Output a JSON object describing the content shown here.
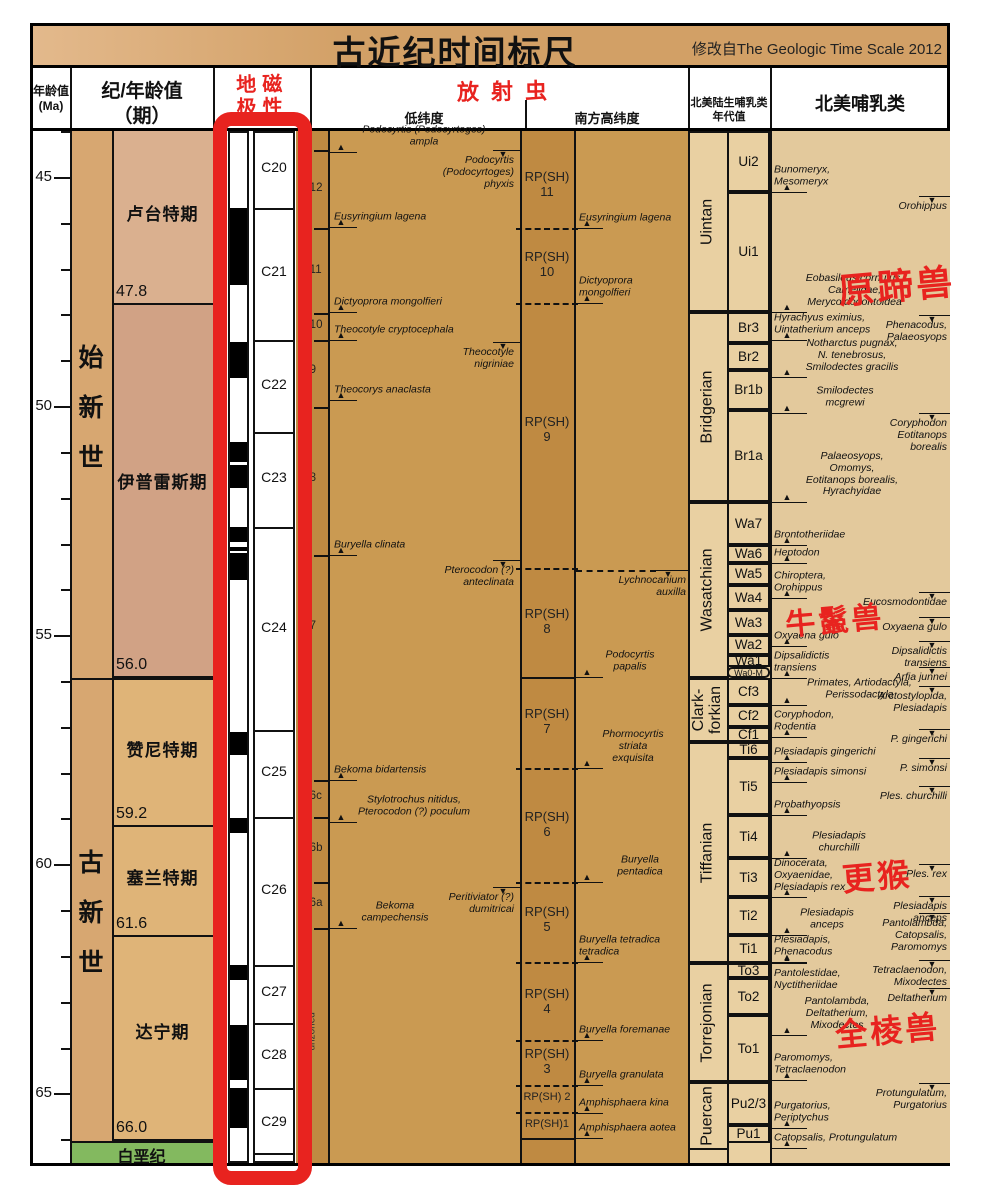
{
  "title": "古近纪时间标尺",
  "source_note": "修改自The Geologic Time Scale 2012",
  "headers": {
    "age": "年龄值\n(Ma)",
    "period": "纪/年龄值\n（期）",
    "magnetic": "地磁\n极性",
    "radiolarian": "放射虫",
    "low_lat": "低纬度",
    "south_high_lat": "南方高纬度",
    "nalma": "北美陆生哺乳类\n年代值",
    "mammal": "北美哺乳类"
  },
  "chart_data": {
    "type": "stratigraphic_time_scale",
    "title": "古近纪时间标尺",
    "source_note": "修改自The Geologic Time Scale 2012",
    "age_axis": {
      "unit": "Ma",
      "major_ticks": [
        45,
        50,
        55,
        60,
        65
      ],
      "minor_ticks": [
        44,
        46,
        47,
        48,
        49,
        51,
        52,
        53,
        54,
        56,
        57,
        58,
        59,
        61,
        62,
        63,
        64,
        66
      ],
      "y_at_45": 177,
      "px_per_ma": 45.82
    },
    "epochs": [
      {
        "name": "始新世",
        "y1": 131,
        "y2": 678
      },
      {
        "name": "古新世",
        "y1": 678,
        "y2": 1141
      }
    ],
    "stages": [
      {
        "name": "卢台特期",
        "y1": 131,
        "y2": 305,
        "color": "#dab08f",
        "label_y": 212
      },
      {
        "name": "伊普雷斯期",
        "y1": 305,
        "y2": 678,
        "color": "#d1a285",
        "label_y": 480
      },
      {
        "name": "赞尼特期",
        "y1": 678,
        "y2": 827,
        "color": "#dfb478",
        "label_y": 748
      },
      {
        "name": "塞兰特期",
        "y1": 827,
        "y2": 937,
        "color": "#dfb478",
        "label_y": 876
      },
      {
        "name": "达宁期",
        "y1": 937,
        "y2": 1141,
        "color": "#dfb478",
        "label_y": 1030
      }
    ],
    "boundary_ages": [
      {
        "v": "47.8",
        "y": 305
      },
      {
        "v": "56.0",
        "y": 678
      },
      {
        "v": "59.2",
        "y": 827
      },
      {
        "v": "61.6",
        "y": 937
      },
      {
        "v": "66.0",
        "y": 1141
      }
    ],
    "cretaceous": {
      "label": "白垩纪",
      "y1": 1141,
      "y2": 1163,
      "color": "#83b95f"
    },
    "polarity": {
      "black_segments": [
        [
          208,
          285
        ],
        [
          342,
          378
        ],
        [
          442,
          462
        ],
        [
          465,
          488
        ],
        [
          527,
          542
        ],
        [
          547,
          551
        ],
        [
          553,
          580
        ],
        [
          732,
          755
        ],
        [
          818,
          833
        ],
        [
          965,
          980
        ],
        [
          1025,
          1080
        ],
        [
          1088,
          1128
        ]
      ],
      "chron_dividers": [
        208,
        340,
        432,
        527,
        730,
        817,
        965,
        1023,
        1088,
        1153
      ],
      "chrons": [
        {
          "label": "C20",
          "y": 168
        },
        {
          "label": "C21",
          "y": 272
        },
        {
          "label": "C22",
          "y": 385
        },
        {
          "label": "C23",
          "y": 478
        },
        {
          "label": "C24",
          "y": 628
        },
        {
          "label": "C25",
          "y": 772
        },
        {
          "label": "C26",
          "y": 890
        },
        {
          "label": "C27",
          "y": 992
        },
        {
          "label": "C28",
          "y": 1055
        },
        {
          "label": "C29",
          "y": 1122
        }
      ]
    },
    "p_zones": {
      "labels": [
        {
          "t": "P12",
          "y": 190
        },
        {
          "t": "P11",
          "y": 272
        },
        {
          "t": "P10",
          "y": 327
        },
        {
          "t": "P9",
          "y": 372
        },
        {
          "t": "P8",
          "y": 480
        },
        {
          "t": "P7",
          "y": 628
        },
        {
          "t": "P6c",
          "y": 798
        },
        {
          "t": "P6b",
          "y": 850
        },
        {
          "t": "P6a",
          "y": 905
        }
      ],
      "ticks": [
        150,
        228,
        313,
        340,
        407,
        555,
        780,
        817,
        882,
        928
      ],
      "unzoned": {
        "t": "unzoned",
        "y": 1045
      }
    },
    "rp_zones": {
      "labels": [
        {
          "n": "RP(SH)\n11",
          "y": 185
        },
        {
          "n": "RP(SH)\n10",
          "y": 265
        },
        {
          "n": "RP(SH)\n9",
          "y": 430
        },
        {
          "n": "RP(SH)\n8",
          "y": 622
        },
        {
          "n": "RP(SH)\n7",
          "y": 722
        },
        {
          "n": "RP(SH)\n6",
          "y": 825
        },
        {
          "n": "RP(SH)\n5",
          "y": 920
        },
        {
          "n": "RP(SH)\n4",
          "y": 1002
        },
        {
          "n": "RP(SH)\n3",
          "y": 1062
        },
        {
          "n": "RP(SH) 2",
          "y": 1098,
          "s": 1
        },
        {
          "n": "RP(SH)1",
          "y": 1125,
          "s": 1
        }
      ],
      "dashed_boundaries": [
        228,
        303,
        568,
        768,
        882,
        962,
        1040,
        1085,
        1112
      ],
      "solid_boundaries": [
        677,
        1138
      ],
      "long_dash_y": 570
    },
    "lowlat_events": [
      {
        "t": "Podocyrtis (Podocyrtoges)\nampla",
        "y": 152,
        "c": 1,
        "w": 180
      },
      {
        "t": "Podocyrtis\n(Podocyrtoges)\nphyxis",
        "y": 150,
        "d": "d"
      },
      {
        "t": "Eusyringium lagena",
        "y": 227
      },
      {
        "t": "Dictyoprora mongolfieri",
        "y": 312
      },
      {
        "t": "Theocotyle cryptocephala",
        "y": 340
      },
      {
        "t": "Theocotyle\nnigriniae",
        "y": 342,
        "d": "d"
      },
      {
        "t": "Theocorys anaclasta",
        "y": 400
      },
      {
        "t": "Buryella clinata",
        "y": 555
      },
      {
        "t": "Pterocodon (?)\nanteclinata",
        "y": 560,
        "d": "d"
      },
      {
        "t": "Bekoma bidartensis",
        "y": 780
      },
      {
        "t": "Stylotrochus nitidus,\nPterocodon (?) poculum",
        "y": 822,
        "c": 1,
        "w": 160
      },
      {
        "t": "Peritiviator (?)\ndumitricai",
        "y": 887,
        "d": "d"
      },
      {
        "t": "Bekoma\ncampechensis",
        "y": 928,
        "c": 1,
        "lx": 340,
        "w": 110
      }
    ],
    "south_events": [
      {
        "t": "Eusyringium lagena",
        "y": 228
      },
      {
        "t": "Dictyoprora\nmongolfieri",
        "y": 303
      },
      {
        "t": "Lychnocanium\nauxilla",
        "y": 570,
        "d": "d"
      },
      {
        "t": "Podocyrtis\npapalis",
        "y": 677,
        "c": 1,
        "lx": 590,
        "w": 80
      },
      {
        "t": "Phormocyrtis\nstriata\nexquisita",
        "y": 768,
        "c": 1,
        "lx": 588,
        "w": 90
      },
      {
        "t": "Buryella\npentadica",
        "y": 882,
        "c": 1,
        "lx": 600,
        "w": 80
      },
      {
        "t": "Buryella tetradica\ntetradica",
        "y": 962
      },
      {
        "t": "Buryella foremanae",
        "y": 1040
      },
      {
        "t": "Buryella granulata",
        "y": 1085
      },
      {
        "t": "Amphisphaera kina",
        "y": 1113
      },
      {
        "t": "Amphisphaera aotea",
        "y": 1138
      }
    ],
    "nalma_groups": [
      {
        "t": "Uintan",
        "y1": 131,
        "y2": 312
      },
      {
        "t": "Bridgerian",
        "y1": 312,
        "y2": 502
      },
      {
        "t": "Wasatchian",
        "y1": 502,
        "y2": 678
      },
      {
        "t": "Clark-\nforkian",
        "y1": 678,
        "y2": 742
      },
      {
        "t": "Tiffanian",
        "y1": 742,
        "y2": 963
      },
      {
        "t": "Torrejonian",
        "y1": 963,
        "y2": 1082
      },
      {
        "t": "Puercan",
        "y1": 1082,
        "y2": 1150
      }
    ],
    "nalma_zones": [
      {
        "t": "Ui2",
        "y1": 131,
        "y2": 192
      },
      {
        "t": "Ui1",
        "y1": 192,
        "y2": 312
      },
      {
        "t": "Br3",
        "y1": 312,
        "y2": 343
      },
      {
        "t": "Br2",
        "y1": 343,
        "y2": 370
      },
      {
        "t": "Br1b",
        "y1": 370,
        "y2": 410
      },
      {
        "t": "Br1a",
        "y1": 410,
        "y2": 502
      },
      {
        "t": "Wa7",
        "y1": 502,
        "y2": 545
      },
      {
        "t": "Wa6",
        "y1": 545,
        "y2": 563
      },
      {
        "t": "Wa5",
        "y1": 563,
        "y2": 585
      },
      {
        "t": "Wa4",
        "y1": 585,
        "y2": 610
      },
      {
        "t": "Wa3",
        "y1": 610,
        "y2": 635
      },
      {
        "t": "Wa2",
        "y1": 635,
        "y2": 655
      },
      {
        "t": "Wa1",
        "y1": 655,
        "y2": 667
      },
      {
        "t": "Wa0-M",
        "y1": 667,
        "y2": 678,
        "small": 1
      },
      {
        "t": "Cf3",
        "y1": 678,
        "y2": 705
      },
      {
        "t": "Cf2",
        "y1": 705,
        "y2": 727
      },
      {
        "t": "Cf1",
        "y1": 727,
        "y2": 742
      },
      {
        "t": "Ti6",
        "y1": 742,
        "y2": 758
      },
      {
        "t": "Ti5",
        "y1": 758,
        "y2": 815
      },
      {
        "t": "Ti4",
        "y1": 815,
        "y2": 858
      },
      {
        "t": "Ti3",
        "y1": 858,
        "y2": 897
      },
      {
        "t": "Ti2",
        "y1": 897,
        "y2": 935
      },
      {
        "t": "Ti1",
        "y1": 935,
        "y2": 963
      },
      {
        "t": "To3",
        "y1": 963,
        "y2": 978
      },
      {
        "t": "To2",
        "y1": 978,
        "y2": 1015
      },
      {
        "t": "To1",
        "y1": 1015,
        "y2": 1082
      },
      {
        "t": "Pu2/3",
        "y1": 1082,
        "y2": 1125
      },
      {
        "t": "Pu1",
        "y1": 1125,
        "y2": 1143
      }
    ],
    "mammal_events_left": [
      {
        "t": "Bunomeryx,\nMesomeryx",
        "y": 192
      },
      {
        "t": "Eobasileus cornutus,\nCamelidae,\nMerycoidodontoidea",
        "y": 312,
        "c": 1,
        "lx": 772,
        "w": 165
      },
      {
        "t": "Hyrachyus eximius,\nUintatherium anceps",
        "y": 340
      },
      {
        "t": "Notharctus pugnax,\nN. tenebrosus,\nSmilodectes gracilis",
        "y": 377,
        "c": 1,
        "lx": 772,
        "w": 160
      },
      {
        "t": "Smilodectes\nmcgrewi",
        "y": 413,
        "c": 1,
        "lx": 790,
        "w": 110
      },
      {
        "t": "Palaeosyops,\nOmomys,\nEotitanops borealis,\nHyrachyidae",
        "y": 502,
        "c": 1,
        "lx": 772,
        "w": 160
      },
      {
        "t": "Brontotheriidae",
        "y": 545
      },
      {
        "t": "Heptodon",
        "y": 563
      },
      {
        "t": "Chiroptera,\nOrohippus",
        "y": 598
      },
      {
        "t": "Oxyaena gulo",
        "y": 646
      },
      {
        "t": "Dipsalidictis\ntransiens",
        "y": 678
      },
      {
        "t": "Primates, Artiodactyla,\nPerissodactyla",
        "y": 705,
        "c": 1,
        "lx": 772,
        "w": 175
      },
      {
        "t": "Coryphodon,\nRodentia",
        "y": 737
      },
      {
        "t": "Plesiadapis gingerichi",
        "y": 762
      },
      {
        "t": "Plesiadapis simonsi",
        "y": 782
      },
      {
        "t": "Probathyopsis",
        "y": 815
      },
      {
        "t": "Plesiadapis\nchurchilli",
        "y": 858,
        "c": 1,
        "lx": 784,
        "w": 110
      },
      {
        "t": "Dinocerata,\nOxyaenidae,\nPlesiadapis rex",
        "y": 897
      },
      {
        "t": "Plesiadapis\nanceps",
        "y": 935,
        "c": 1,
        "lx": 772,
        "w": 110
      },
      {
        "t": "Plesiadapis,\nPhenacodus",
        "y": 962
      },
      {
        "t": "Pantolestidae,\nNyctitheriidae",
        "y": 963,
        "lb": 1
      },
      {
        "t": "Pantolambda,\nDeltatherium,\nMixodectes",
        "y": 1035,
        "c": 1,
        "lx": 772,
        "w": 130
      },
      {
        "t": "Paromomys,\nTetraclaenodon",
        "y": 1080
      },
      {
        "t": "Purgatorius,\nPeriptychus",
        "y": 1128
      },
      {
        "t": "Catopsalis, Protungulatum",
        "y": 1148
      }
    ],
    "mammal_events_right": [
      {
        "t": "Orohippus",
        "y": 196
      },
      {
        "t": "Phenacodus,\nPalaeosyops",
        "y": 315
      },
      {
        "t": "Coryphodon\nEotitanops\nborealis",
        "y": 413
      },
      {
        "t": "Eucosmodontidae",
        "y": 592
      },
      {
        "t": "Oxyaena gulo",
        "y": 617
      },
      {
        "t": "Dipsalidictis\ntransiens",
        "y": 641
      },
      {
        "t": "Arfia junnei",
        "y": 667
      },
      {
        "t": "Arctostylopida,\nPlesiadapis",
        "y": 686
      },
      {
        "t": "P. gingerichi",
        "y": 729
      },
      {
        "t": "P. simonsi",
        "y": 758
      },
      {
        "t": "Ples. churchilli",
        "y": 786
      },
      {
        "t": "Ples. rex",
        "y": 864
      },
      {
        "t": "Plesiadapis\nanceps",
        "y": 896
      },
      {
        "t": "Pantolambda,\nCatopsalis,\nParomomys",
        "y": 913
      },
      {
        "t": "Tetraclaenodon,\nMixodectes",
        "y": 960
      },
      {
        "t": "Deltatherium",
        "y": 988
      },
      {
        "t": "Protungulatum,\nPurgatorius",
        "y": 1083
      }
    ],
    "annotations": [
      {
        "t": "原蹄兽",
        "x": 838,
        "y": 258,
        "size": 36
      },
      {
        "t": "牛鬣兽",
        "x": 785,
        "y": 596,
        "size": 30
      },
      {
        "t": "更猴",
        "x": 842,
        "y": 852,
        "size": 32
      },
      {
        "t": "全棱兽",
        "x": 835,
        "y": 1006,
        "size": 32
      }
    ],
    "colors": {
      "accent_red": "#e8231f",
      "title_bar": "#d2a066",
      "epoch": "#d7a771",
      "lutetian": "#dab08f",
      "ypresian": "#d1a285",
      "paleocene_stage": "#dfb478",
      "cretaceous_green": "#83b95f",
      "radiolarian_col": "#ca9a52",
      "zone_col_dark": "#bf8a42",
      "nalma_col": "#e9d0a2",
      "mammal_col": "#e3c99c"
    }
  }
}
